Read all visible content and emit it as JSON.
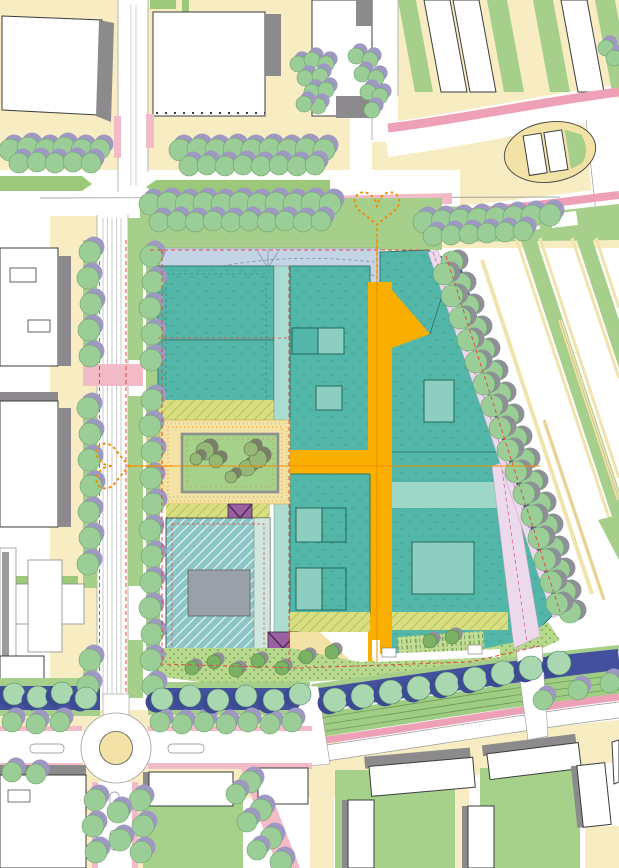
{
  "page": {
    "title": "Urban masterplan site drawing",
    "kind": "map"
  },
  "map": {
    "canvas": {
      "width_px": 619,
      "height_px": 868
    },
    "features": [
      {
        "name": "development-parcel",
        "color": "#52b6a9"
      },
      {
        "name": "parcel-courtyard-block",
        "color": "#8ccfc0"
      },
      {
        "name": "main-street-orange",
        "color": "#f9ae00"
      },
      {
        "name": "entry-plaza-band",
        "color": "#c5d4e4"
      },
      {
        "name": "canal-water",
        "color": "#42509e"
      },
      {
        "name": "street-tree",
        "color": "#9bcd97"
      },
      {
        "name": "tree-shadow",
        "color": "#9e98c2"
      },
      {
        "name": "grass-verge",
        "color": "#a6cf8b"
      },
      {
        "name": "sidewalk-paving",
        "color": "#f8edc2"
      },
      {
        "name": "road-edge-cycleway",
        "color": "#f3bac7"
      },
      {
        "name": "existing-building",
        "color": "#ffffff"
      },
      {
        "name": "building-shadow",
        "color": "#8d8a8d"
      },
      {
        "name": "special-crossing-x",
        "color": "#9d5fa3"
      },
      {
        "name": "heart-entrance-marker",
        "color": "#ef8e00"
      },
      {
        "name": "dotted-park-strip",
        "color": "#b8d88c"
      },
      {
        "name": "hatched-reserved-parcel",
        "color": "#8cc5c5"
      },
      {
        "name": "lilac-path",
        "color": "#ecd9ec"
      },
      {
        "name": "allotment-strips",
        "color": "#a6cf8b"
      }
    ]
  },
  "colors": {
    "paper": "#ffffff",
    "cream": "#f8edc2",
    "creamDeep": "#f3e2a6",
    "greenVerge": "#a6cf8b",
    "greenStrip": "#9cc979",
    "lawn": "#a5d18b",
    "treeGreen": "#9bcd97",
    "treePale": "#a9d8b0",
    "treeDark": "#79b264",
    "treeOlive": "#96b877",
    "shadowPurple": "#9e98c2",
    "shadowGray": "#8f8f98",
    "shadowBlue": "#3c4a94",
    "shadowOlive": "#7a7f68",
    "teal": "#52b6a9",
    "tealLight": "#8ccfc0",
    "tealPale": "#aadcd1",
    "tealBand": "#9ed6c8",
    "orange": "#f9ae00",
    "orangeLine": "#ef8e00",
    "blueCanal": "#42509e",
    "blueBand": "#c5d4e4",
    "hatchTealBase": "#8cc5c5",
    "hatchTealLine": "#e9f5f3",
    "hatchYellowBase": "#dade83",
    "hatchYellowLine": "#aebf52",
    "dotBase": "#b8d88c",
    "dotInk": "#7ba85b",
    "gardenBase": "#c4dd95",
    "gardenInk": "#6f9e55",
    "grayBuilding": "#8d8a8d",
    "outline": "#3c3c3c",
    "pinkRoad": "#f3bac7",
    "pinkStrong": "#eda0b6",
    "lilac": "#ecd9ec",
    "lilacLine": "#d16a9a",
    "purpleX": "#9d5fa3",
    "redDash": "#e04b3f",
    "roadOutline": "#9a9a9a"
  }
}
